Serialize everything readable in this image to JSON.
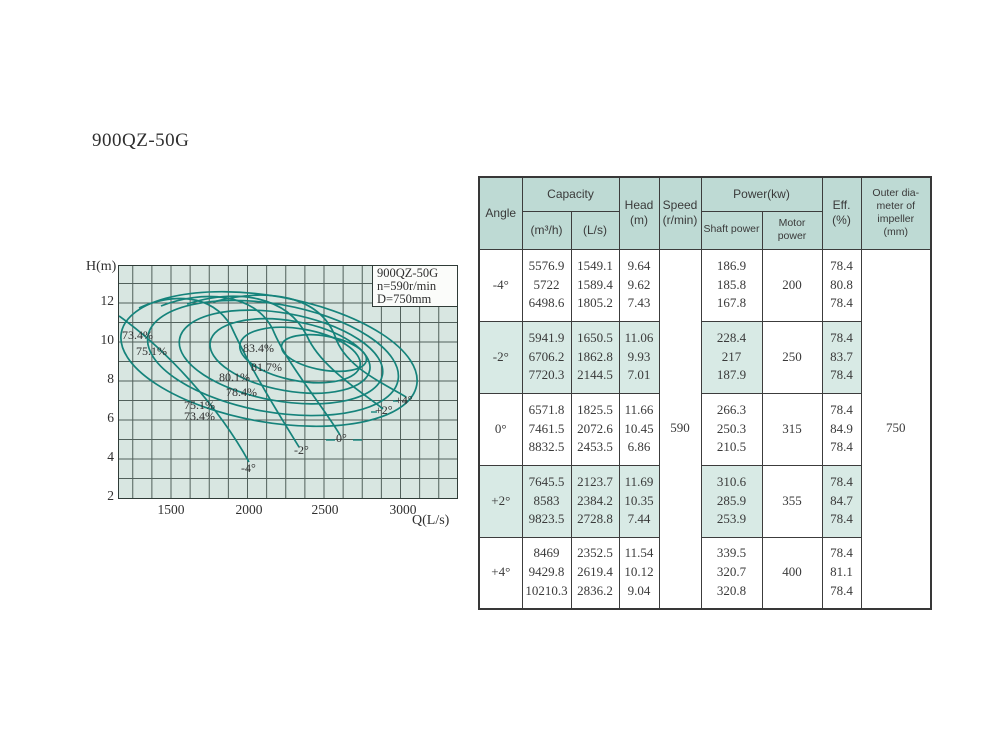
{
  "page": {
    "title": "900QZ-50G"
  },
  "chart": {
    "y_axis_label": "H(m)",
    "x_axis_label": "Q(L/s)",
    "y_ticks": [
      "12",
      "10",
      "8",
      "6",
      "4",
      "2"
    ],
    "x_ticks": [
      "1500",
      "2000",
      "2500",
      "3000"
    ],
    "legend": {
      "line1": "900QZ-50G",
      "line2": "n=590r/min",
      "line3": "D=750mm"
    },
    "efficiency_labels": [
      "73.4%",
      "75.1%",
      "83.4%",
      "81.7%",
      "80.1%",
      "78.4%",
      "75.1%",
      "73.4%"
    ],
    "angle_labels": [
      "-4°",
      "-2°",
      "0°",
      "+2°",
      "+4°"
    ]
  },
  "chart_data": {
    "type": "line",
    "title": "900QZ-50G pump performance curves",
    "annotation": [
      "900QZ-50G",
      "n=590r/min",
      "D=750mm"
    ],
    "xlabel": "Q(L/s)",
    "ylabel": "H(m)",
    "xlim": [
      1160,
      3360
    ],
    "ylim": [
      2,
      14
    ],
    "xticks": [
      1500,
      2000,
      2500,
      3000
    ],
    "yticks": [
      2,
      4,
      6,
      8,
      10,
      12
    ],
    "grid": true,
    "efficiency_contours_pct": [
      73.4,
      75.1,
      78.4,
      80.1,
      81.7,
      83.4
    ],
    "series": [
      {
        "name": "-4°",
        "points_Q_Ls_vs_H_m": [
          [
            1549.1,
            9.64
          ],
          [
            1589.4,
            9.62
          ],
          [
            1805.2,
            7.43
          ]
        ]
      },
      {
        "name": "-2°",
        "points_Q_Ls_vs_H_m": [
          [
            1650.5,
            11.06
          ],
          [
            1862.8,
            9.93
          ],
          [
            2144.5,
            7.01
          ]
        ]
      },
      {
        "name": "0°",
        "points_Q_Ls_vs_H_m": [
          [
            1825.5,
            11.66
          ],
          [
            2072.6,
            10.45
          ],
          [
            2453.5,
            6.86
          ]
        ]
      },
      {
        "name": "+2°",
        "points_Q_Ls_vs_H_m": [
          [
            2123.7,
            11.69
          ],
          [
            2384.2,
            10.35
          ],
          [
            2728.8,
            7.44
          ]
        ]
      },
      {
        "name": "+4°",
        "points_Q_Ls_vs_H_m": [
          [
            2352.5,
            11.54
          ],
          [
            2619.4,
            10.12
          ],
          [
            2836.2,
            9.04
          ]
        ]
      }
    ]
  },
  "table": {
    "headers": {
      "angle": "Angle",
      "capacity": "Capacity",
      "m3h": "(m³/h)",
      "ls": "(L/s)",
      "head": "Head\n(m)",
      "speed": "Speed\n(r/min)",
      "power": "Power(kw)",
      "shaft": "Shaft power",
      "motor": "Motor power",
      "eff": "Eff.\n(%)",
      "outer": "Outer dia-\nmeter of\nimpeller\n(mm)"
    },
    "speed_value": "590",
    "outer_diameter_value": "750",
    "rows": [
      {
        "angle": "-4°",
        "m3h": [
          "5576.9",
          "5722",
          "6498.6"
        ],
        "ls": [
          "1549.1",
          "1589.4",
          "1805.2"
        ],
        "head": [
          "9.64",
          "9.62",
          "7.43"
        ],
        "shaft": [
          "186.9",
          "185.8",
          "167.8"
        ],
        "motor": "200",
        "eff": [
          "78.4",
          "80.8",
          "78.4"
        ]
      },
      {
        "angle": "-2°",
        "m3h": [
          "5941.9",
          "6706.2",
          "7720.3"
        ],
        "ls": [
          "1650.5",
          "1862.8",
          "2144.5"
        ],
        "head": [
          "11.06",
          "9.93",
          "7.01"
        ],
        "shaft": [
          "228.4",
          "217",
          "187.9"
        ],
        "motor": "250",
        "eff": [
          "78.4",
          "83.7",
          "78.4"
        ]
      },
      {
        "angle": "0°",
        "m3h": [
          "6571.8",
          "7461.5",
          "8832.5"
        ],
        "ls": [
          "1825.5",
          "2072.6",
          "2453.5"
        ],
        "head": [
          "11.66",
          "10.45",
          "6.86"
        ],
        "shaft": [
          "266.3",
          "250.3",
          "210.5"
        ],
        "motor": "315",
        "eff": [
          "78.4",
          "84.9",
          "78.4"
        ]
      },
      {
        "angle": "+2°",
        "m3h": [
          "7645.5",
          "8583",
          "9823.5"
        ],
        "ls": [
          "2123.7",
          "2384.2",
          "2728.8"
        ],
        "head": [
          "11.69",
          "10.35",
          "7.44"
        ],
        "shaft": [
          "310.6",
          "285.9",
          "253.9"
        ],
        "motor": "355",
        "eff": [
          "78.4",
          "84.7",
          "78.4"
        ]
      },
      {
        "angle": "+4°",
        "m3h": [
          "8469",
          "9429.8",
          "10210.3"
        ],
        "ls": [
          "2352.5",
          "2619.4",
          "2836.2"
        ],
        "head": [
          "11.54",
          "10.12",
          "9.04"
        ],
        "shaft": [
          "339.5",
          "320.7",
          "320.8"
        ],
        "motor": "400",
        "eff": [
          "78.4",
          "81.1",
          "78.4"
        ]
      }
    ]
  }
}
